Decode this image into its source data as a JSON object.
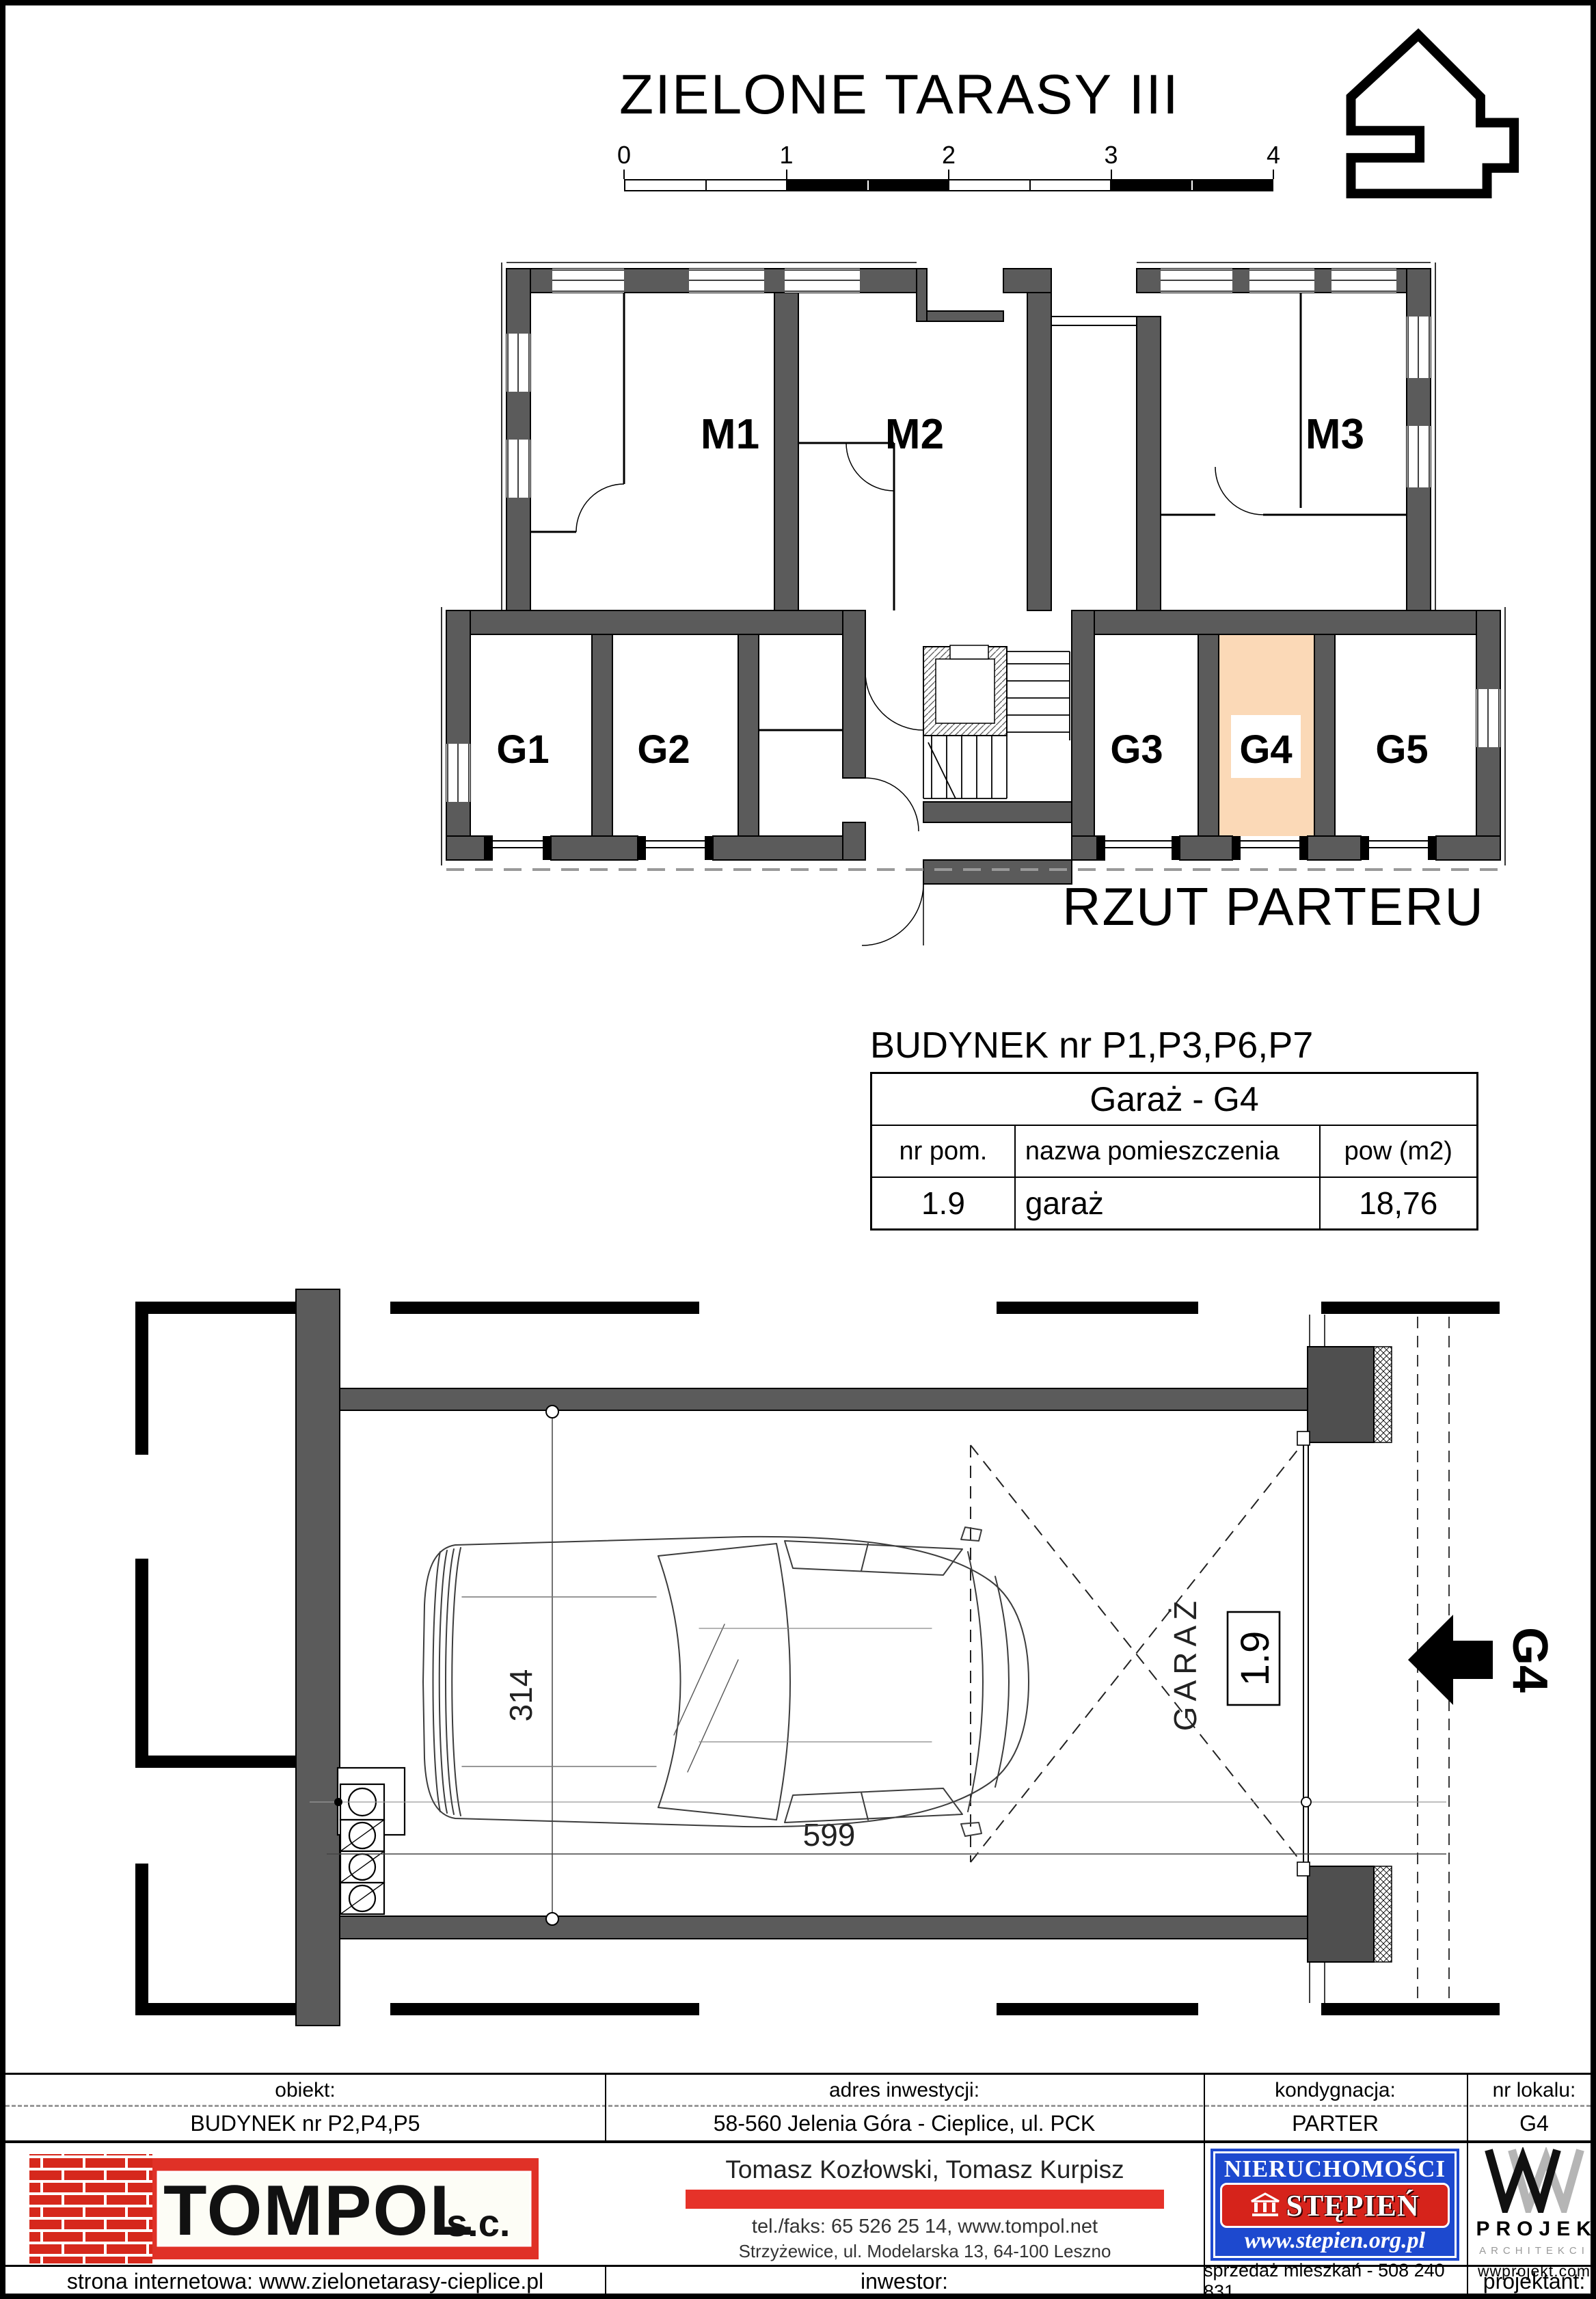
{
  "page": {
    "title": "ZIELONE TARASY III"
  },
  "scalebar": {
    "labels": [
      "0",
      "1",
      "2",
      "3",
      "4"
    ]
  },
  "plan": {
    "title": "RZUT PARTERU",
    "apartments": [
      "M1",
      "M2",
      "M3"
    ],
    "garages": [
      "G1",
      "G2",
      "G3",
      "G4",
      "G5"
    ],
    "highlight_unit": "G4",
    "highlight_color": "#fbd9b7"
  },
  "unit_table": {
    "building": "BUDYNEK nr P1,P3,P6,P7",
    "title": "Garaż - G4",
    "headers": [
      "nr pom.",
      "nazwa pomieszczenia",
      "pow (m2)"
    ],
    "rows": [
      [
        "1.9",
        "garaż",
        "18,76"
      ]
    ]
  },
  "detail_plan": {
    "room_label": "GARAŻ",
    "room_number": "1.9",
    "width_cm": "599",
    "depth_cm": "314",
    "unit_label": "G4"
  },
  "footer": {
    "cols": [
      {
        "header": "obiekt:",
        "value": "BUDYNEK nr P2,P4,P5",
        "bottom": "strona internetowa: www.zielonetarasy-cieplice.pl"
      },
      {
        "header": "adres inwestycji:",
        "value": "58-560 Jelenia Góra - Cieplice, ul. PCK",
        "bottom": "inwestor:"
      },
      {
        "header": "kondygnacja:",
        "value": "PARTER",
        "bottom": "sprzedaż mieszkań - 508 240 831"
      },
      {
        "header": "nr lokalu:",
        "value": "G4",
        "bottom": "projektant:"
      }
    ],
    "tompol": {
      "name": "TOMPOL",
      "suffix": "s.c.",
      "partners": "Tomasz Kozłowski, Tomasz Kurpisz",
      "phone": "tel./faks: 65 526 25 14,  www.tompol.net",
      "address": "Strzyżewice, ul. Modelarska 13, 64-100 Leszno"
    },
    "stepien": {
      "line1": "NIERUCHOMOŚCI",
      "line2": "STĘPIEŃ",
      "url": "www.stepien.org.pl"
    },
    "wprojekt": {
      "name": "PROJEKT",
      "sub": "ARCHITEKCI",
      "url": "wwprojekt.com"
    }
  },
  "colors": {
    "wall_gray": "#5b5b5b",
    "highlight_peach": "#fbd9b7",
    "tompol_red": "#e03127",
    "stepien_blue": "#1d49cf",
    "stepien_red": "#d6231b"
  }
}
